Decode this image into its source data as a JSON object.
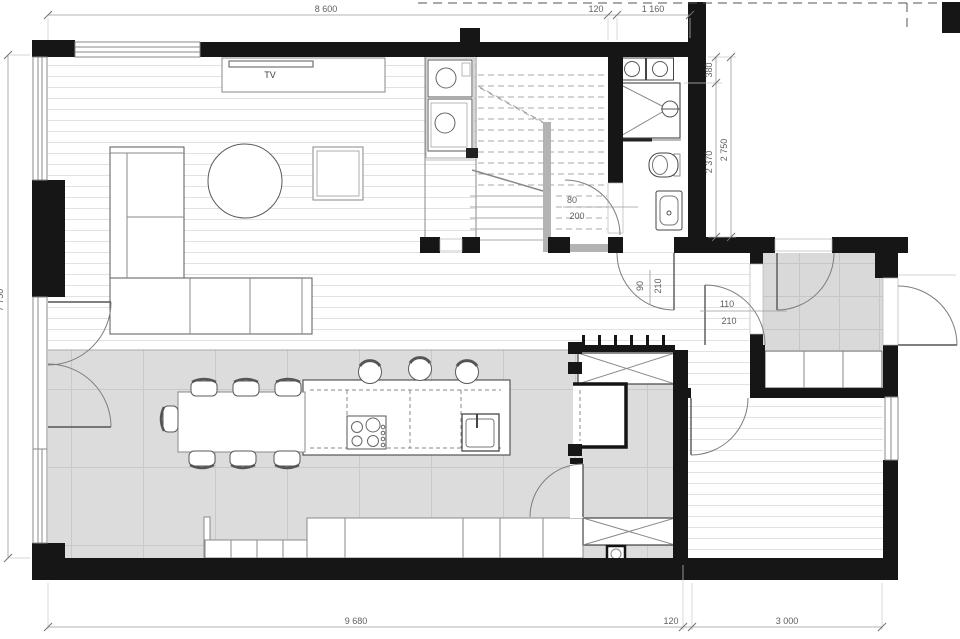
{
  "plan": {
    "labels": {
      "tv": "TV",
      "door_stair": {
        "w": "80",
        "h": "200"
      },
      "door_hall": {
        "w": "90",
        "h": "210"
      },
      "door_vestibule": {
        "w": "110",
        "h": "210"
      }
    },
    "dims": {
      "top": {
        "main": "8 600",
        "wall": "120",
        "entry": "1 160"
      },
      "bottom": {
        "main": "9 680",
        "wall": "120",
        "entry": "3 000"
      },
      "right": {
        "a": "380",
        "b": "2 370",
        "total": "2 750"
      },
      "left": {
        "total": "7 750"
      }
    },
    "colors": {
      "wall": "#161616",
      "tile_floor": "#dcdcdc",
      "tile_grid": "#c9c9c9",
      "wood_line": "#e2e2e2",
      "dim_line": "#9a9a9a",
      "dim_text": "#5f5f5f",
      "furniture_stroke": "#5a5a5a",
      "stair_stringer": "#b3b3b3"
    }
  }
}
